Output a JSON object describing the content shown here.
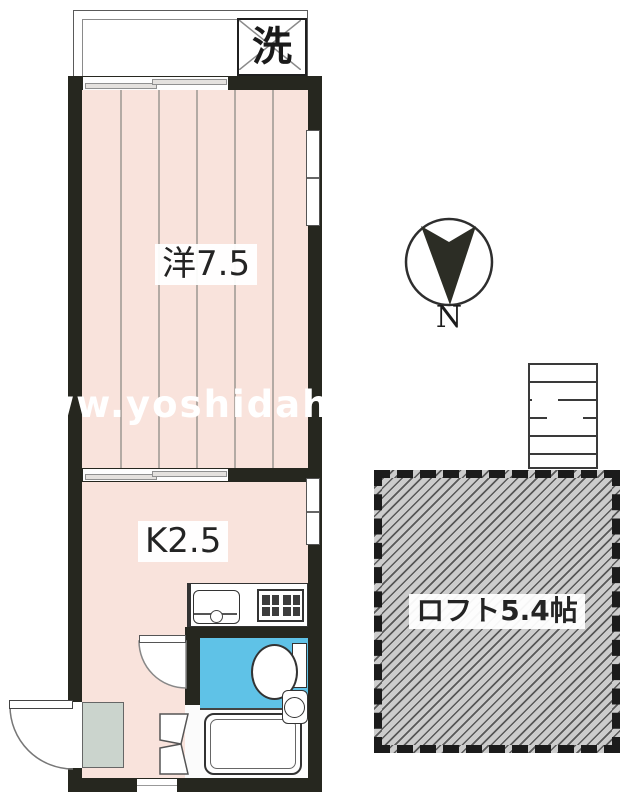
{
  "labels": {
    "western_room": "洋7.5",
    "kitchen": "K2.5",
    "loft": "ロフト5.4帖",
    "laundry": "洗",
    "compass_north": "N",
    "watermark": "ww.yoshidah"
  },
  "colors": {
    "wall": "#26271f",
    "room_pink": "#f9e3dc",
    "bathroom_blue": "#5fc2e7",
    "entrance_mat_gray": "#cbd4cd",
    "loft_hatch_bg": "#cccccc",
    "loft_hatch_line": "#585858",
    "watermark": "#ffffff"
  },
  "compass": {
    "pointing": "down"
  },
  "fixtures": [
    "balcony",
    "washing-machine-space",
    "sliding-window",
    "sliding-door",
    "window",
    "kitchen-sink",
    "gas-stove",
    "toilet",
    "toilet-tank",
    "washbasin",
    "bathtub",
    "folding-door",
    "entrance-door",
    "entrance-mat",
    "interior-door",
    "stairs-to-loft",
    "vent"
  ]
}
